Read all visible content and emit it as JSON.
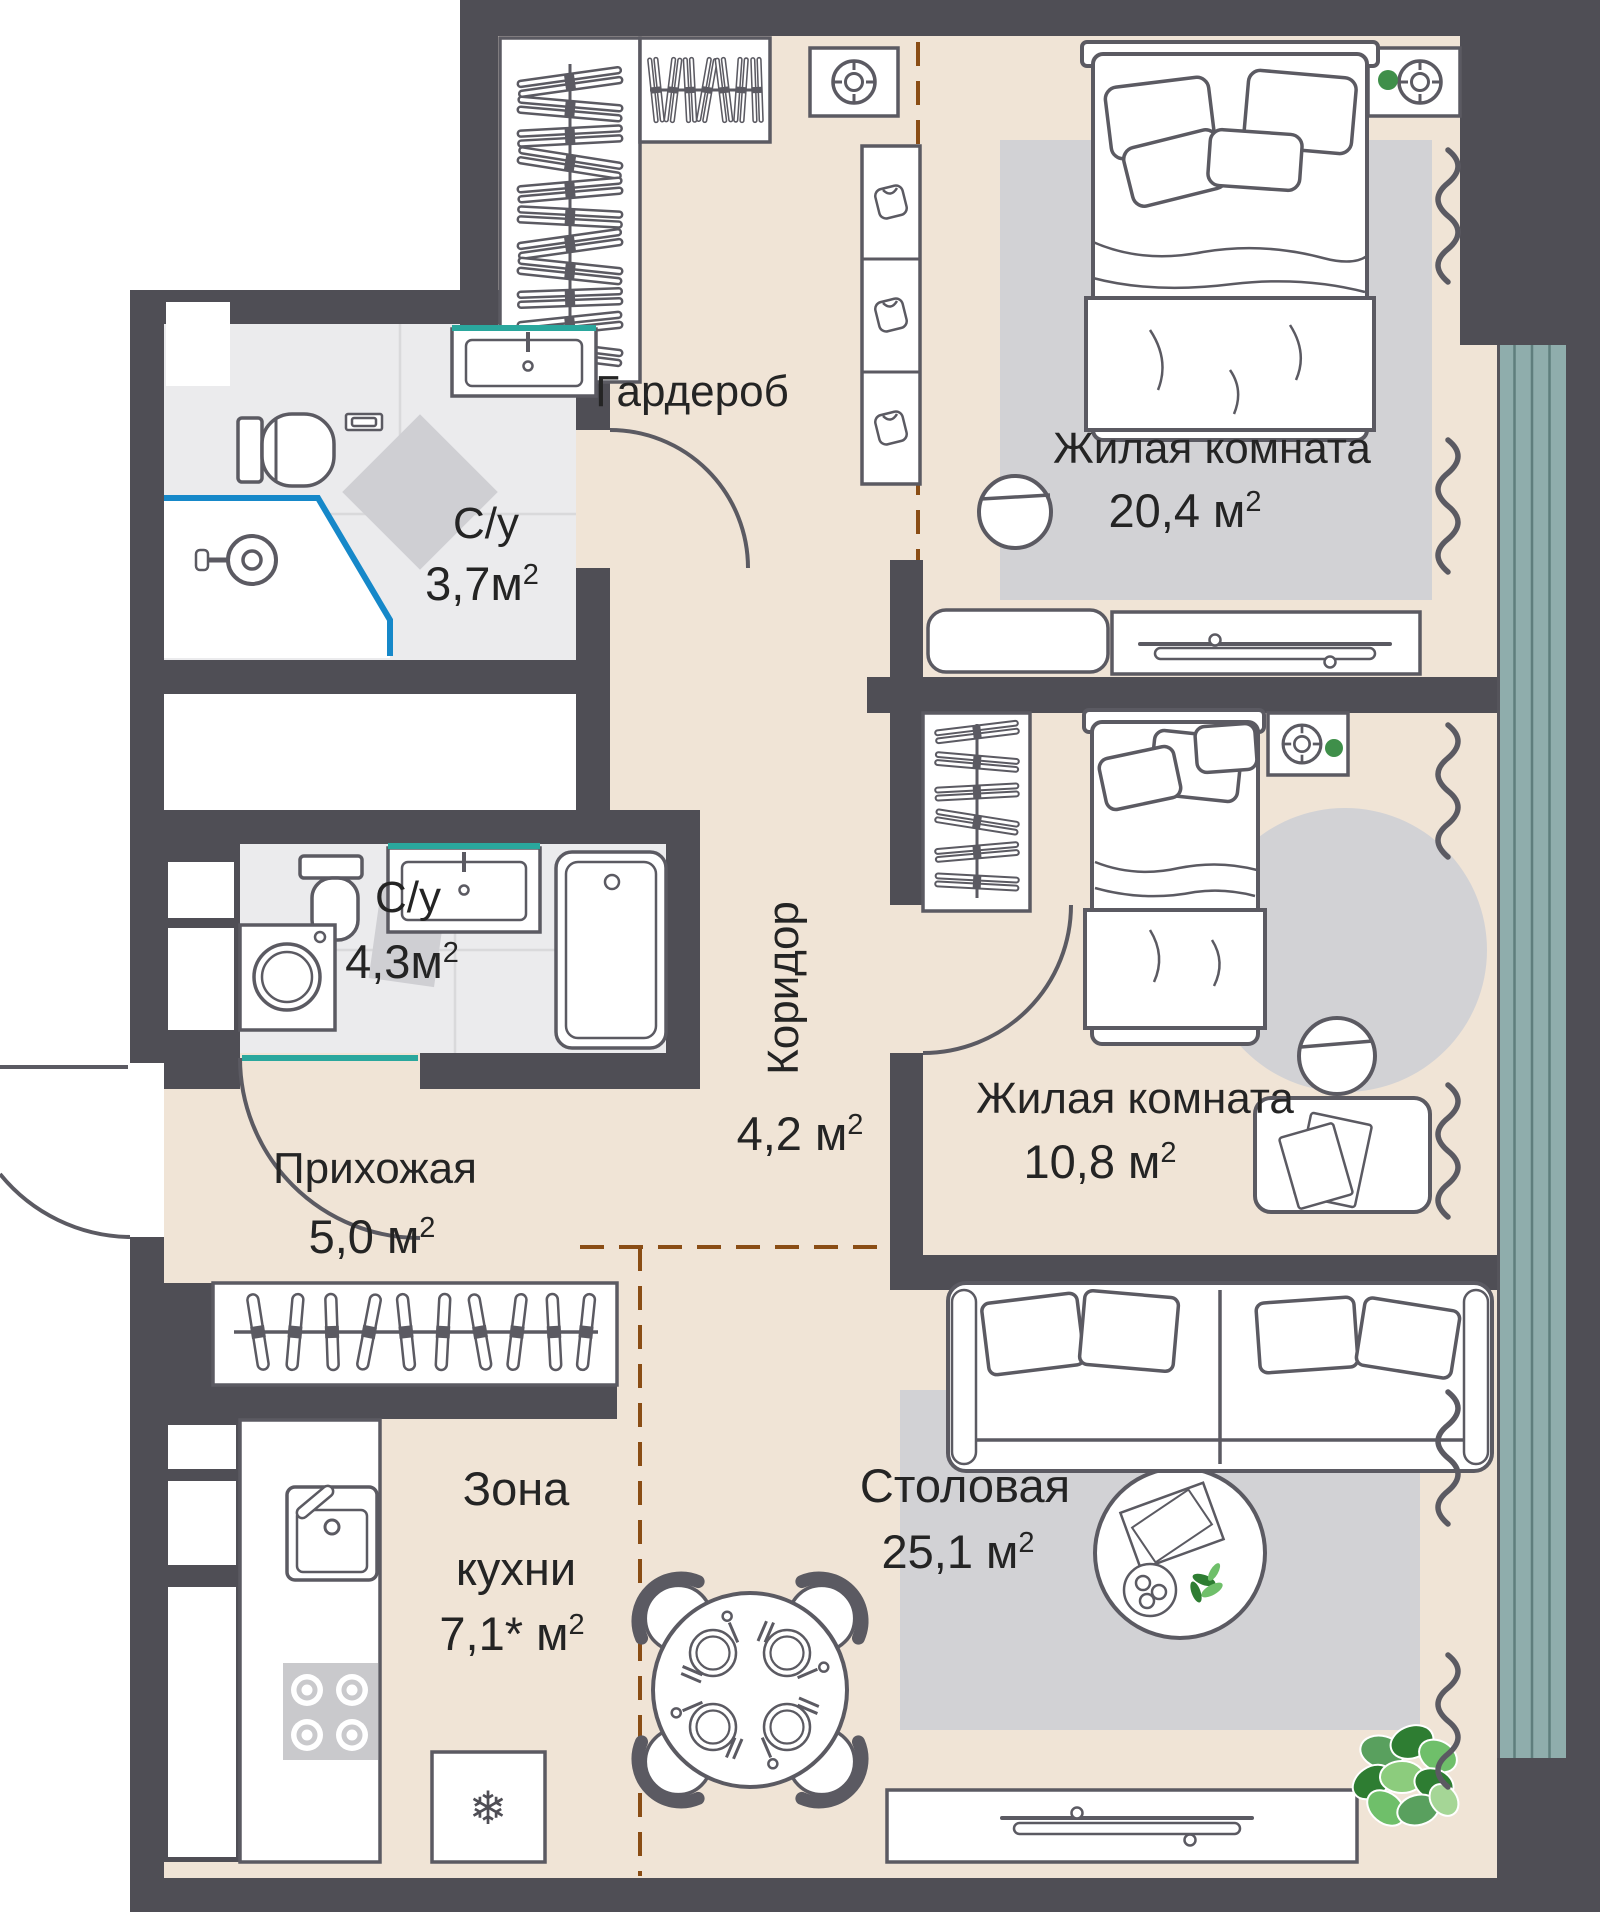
{
  "meta": {
    "type": "apartment-floor-plan",
    "language": "ru"
  },
  "colors": {
    "wall": "#4f4e55",
    "floor_main": "#f0e4d6",
    "floor_wet": "#ebebed",
    "rug": "#d2d2d5",
    "window_glass": "#8fadac",
    "accent_teal": "#2aa79d",
    "shower_blue": "#1688c9",
    "zone_dash_brown": "#8a4d15",
    "furniture_outline": "#5b5a62",
    "text": "#242424",
    "plant_green_dark": "#2e7d32",
    "plant_green_light": "#7cc06e"
  },
  "rooms": {
    "wardrobe": {
      "name": "Гардероб"
    },
    "bedroom1": {
      "name": "Жилая комната",
      "area": "20,4",
      "unit": " м",
      "sup": "2"
    },
    "bath1": {
      "name": "С/у",
      "area": "3,7",
      "unit": "м",
      "sup": "2"
    },
    "bath2": {
      "name": "С/у",
      "area": "4,3",
      "unit": "м",
      "sup": "2"
    },
    "corridor": {
      "name": "Коридор",
      "area": "4,2",
      "unit": " м",
      "sup": "2"
    },
    "bedroom2": {
      "name": "Жилая комната",
      "area": "10,8",
      "unit": " м",
      "sup": "2"
    },
    "hallway": {
      "name": "Прихожая",
      "area": "5,0",
      "unit": " м",
      "sup": "2"
    },
    "kitchen": {
      "name_line1": "Зона",
      "name_line2": "кухни",
      "area": "7,1*",
      "unit": " м",
      "sup": "2"
    },
    "dining": {
      "name": "Столовая",
      "area": "25,1",
      "unit": " м",
      "sup": "2"
    }
  },
  "icons": {
    "fridge_snowflake": "❄"
  }
}
